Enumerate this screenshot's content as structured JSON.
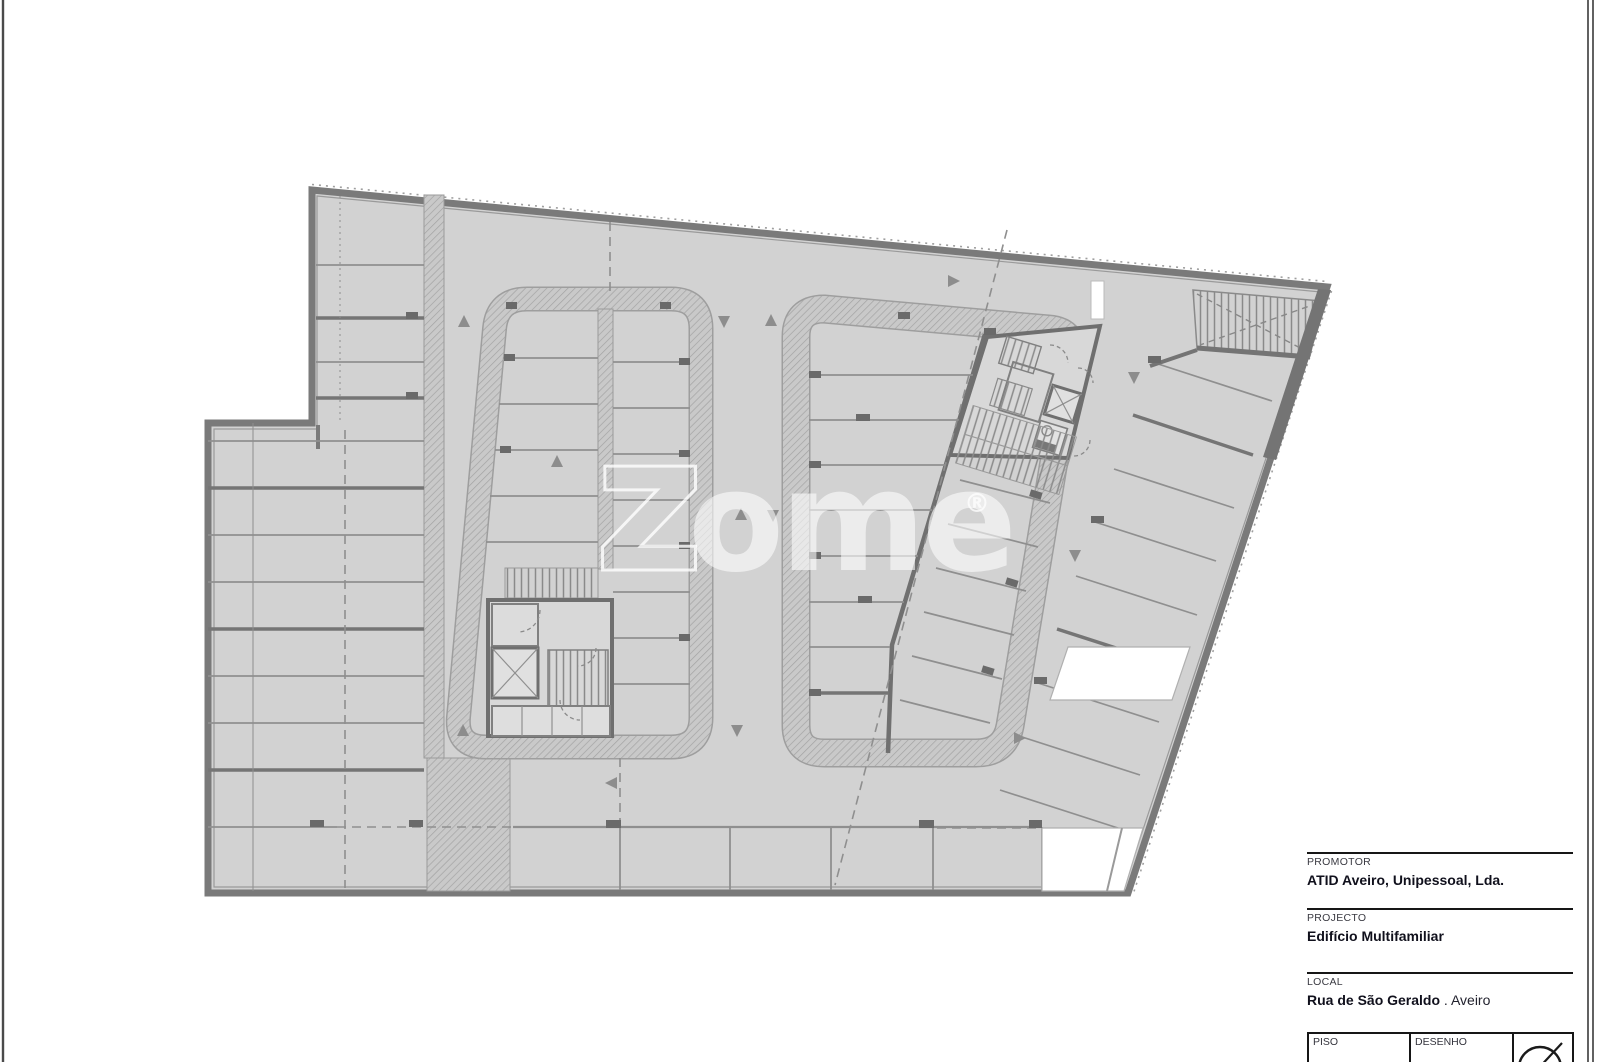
{
  "watermark": {
    "z": "z",
    "ome": "ome",
    "registered": "®"
  },
  "title_block": {
    "promotor": {
      "label": "PROMOTOR",
      "value": "ATID Aveiro, Unipessoal, Lda."
    },
    "projecto": {
      "label": "PROJECTO",
      "value": "Edifício Multifamiliar"
    },
    "local": {
      "label": "LOCAL",
      "value_bold": "Rua de São Geraldo",
      "value_rest": " . Aveiro"
    },
    "table": {
      "piso_label": "PISO",
      "desenho_label": "DESENHO"
    }
  },
  "colors": {
    "floor": "#d2d2d2",
    "wall": "#7a7a7a",
    "hatch_bg": "#c9c9c9",
    "hatch_line": "#a3a3a3",
    "divider": "#8f8f8f",
    "thick_divider": "#757575",
    "tick": "#6a6a6a",
    "dashed": "#8f8f8f",
    "watermark_fill": "rgba(255,255,255,0.58)",
    "frame": "#4a4a4a",
    "title_text": "#10101c"
  }
}
